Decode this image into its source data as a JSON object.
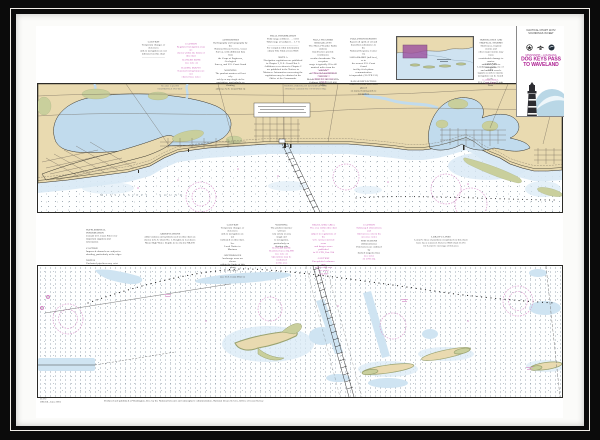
{
  "colors": {
    "frame": "#0b0b0b",
    "fillet": "#f1eee8",
    "matte": "#fbfbf9",
    "paper": "#ffffff",
    "panel_border": "#2b2a26",
    "land": "#e9dab0",
    "marsh": "#c9cf9c",
    "bay": "#c1dbed",
    "shallow": "#d8e9f5",
    "shoreline": "#35332c",
    "road": "#6a6156",
    "channel": "#3a3a3a",
    "magenta": "#c44fae",
    "magenta_light": "#dc9ed0",
    "title_magenta": "#ad1f92",
    "note_black": "#3f3f3f",
    "note_gray": "#7a7a7a",
    "swoosh": "#b9d7e6",
    "lighthouse": "#2c2c31",
    "coverage": "#9b4f9f",
    "inset_water": "#cfe3f1"
  },
  "title_block": {
    "top_line_1": "NAUTICAL CHART 11372",
    "top_line_2": "SOUNDINGS IN FEET",
    "region": "MISSISSIPPI – LOUISIANA",
    "title_line_1": "DOG KEYS PASS",
    "title_line_2": "TO WAVELAND",
    "sub_line_1": "SCALE 1:40,000",
    "sub_line_2": "MERCATOR PROJECTION"
  },
  "chart": {
    "sound_label": "MISSISSIPPI SOUND"
  },
  "micro_notes": [
    {
      "name": "note-caution-aids",
      "x": 102,
      "y": 15,
      "w": 31,
      "color": "#3f3f3f",
      "align": "center",
      "lines": [
        "CAUTION",
        "Temporary changes or defects in",
        "aids to navigation are not",
        "indicated on this chart",
        "—————————"
      ]
    },
    {
      "name": "note-regulated-areas",
      "x": 139,
      "y": 17,
      "w": 32,
      "color": "#c44fae",
      "align": "center",
      "lines": [
        "CAUTION",
        "Regulated navigation areas are",
        "shown within the limits of",
        "this chart"
      ]
    },
    {
      "name": "note-danger-zone",
      "x": 144,
      "y": 33,
      "w": 23,
      "color": "#c44fae",
      "align": "center",
      "lines": [
        "DANGER ZONE",
        "(see note A)"
      ]
    },
    {
      "name": "note-racing-buoys",
      "x": 140,
      "y": 41,
      "w": 30,
      "color": "#c44fae",
      "align": "center",
      "lines": [
        "RACING BUOYS",
        "Seasonal racing buoys are not",
        "charted (see note)"
      ]
    },
    {
      "name": "note-authorities",
      "x": 177,
      "y": 13,
      "w": 35,
      "color": "#3f3f3f",
      "align": "center",
      "lines": [
        "AUTHORITIES",
        "Hydrography and topography by the",
        "National Ocean Service, Coast",
        "Survey, with additional data from",
        "the Corps of Engineers, Geological",
        "Survey, and U.S. Coast Guard",
        "",
        "WARNING",
        "The prudent mariner will not rely",
        "solely on any single aid to",
        "navigation, particularly on floating",
        "aids (see U.S. Coast Pilot 5)"
      ]
    },
    {
      "name": "note-tidal-information",
      "x": 224,
      "y": 9,
      "w": 46,
      "color": "#3f3f3f",
      "align": "center",
      "lines": [
        "TIDAL INFORMATION",
        "Tidal range at Biloxi . . . 1.8 ft",
        "Tidal range at Gulfport . . 1.7 ft",
        "————————————",
        "For complete tidal information",
        "obtain Tide Tables from NOS",
        "",
        "NOTE A",
        "Navigation regulations are published",
        "in Chapter 2, U.S. Coast Pilot 5.",
        "Additions or revisions to Chapter 2",
        "are published in the Notices to",
        "Mariners. Information concerning the",
        "regulations may be obtained at the",
        "Office of the Commander"
      ]
    },
    {
      "name": "note-weather-broadcasts",
      "x": 271,
      "y": 13,
      "w": 32,
      "color": "#3f3f3f",
      "align": "center",
      "lines": [
        "NOAA WEATHER BROADCASTS",
        "The NOAA Weather Radio stations",
        "listed below provide continuous",
        "weather broadcasts. The reception",
        "range is typically 20 to 40",
        "nautical miles from the antenna",
        "site. New Orleans KHB-43 162.550",
        "Mobile KEC-61 162.550 MHz",
        "Gulfport WXJ-99 162.400 MHz"
      ]
    },
    {
      "name": "note-pilings-caution",
      "x": 274,
      "y": 43,
      "w": 27,
      "color": "#c44fae",
      "align": "center",
      "lines": [
        "CAUTION",
        "Submerged pilings and obstructions",
        "exist in this area (see note)"
      ]
    },
    {
      "name": "note-pollution-reports",
      "x": 313,
      "y": 12,
      "w": 29,
      "color": "#3f3f3f",
      "align": "center",
      "lines": [
        "POLLUTION REPORTS",
        "Report all spills of oil and",
        "hazardous substances to the",
        "National Response Center via",
        "1-800-424-8802 (toll free), or to",
        "the nearest U.S. Coast Guard",
        "facility if telephone communication",
        "is impossible (33 CFR 153)",
        "",
        "RADAR REFLECTORS",
        "Radar reflectors have been placed",
        "on many floating aids to navigation"
      ]
    },
    {
      "name": "note-hurricanes",
      "x": 441,
      "y": 13,
      "w": 28,
      "color": "#3f3f3f",
      "align": "center",
      "lines": [
        "HURRICANES AND",
        "TROPICAL STORMS",
        "Hurricanes, tropical storms and",
        "other major storms may cause",
        "considerable damage to marine",
        "structures, aids to navigation",
        "and moored vessels"
      ]
    },
    {
      "name": "note-radio-caution",
      "x": 441,
      "y": 37,
      "w": 27,
      "color": "#3f3f3f",
      "align": "center",
      "lines": [
        "CAUTION",
        "Limitations on the use of radio",
        "signals as aids to marine",
        "navigation can be found in the",
        "U.S. Coast Guard Light Lists"
      ]
    },
    {
      "name": "note-cable-area",
      "x": 443,
      "y": 53,
      "w": 23,
      "color": "#c44fae",
      "align": "center",
      "lines": [
        "CABLE AREA",
        "(see note)"
      ]
    },
    {
      "name": "panel-scale-note",
      "x": 104,
      "y": 59,
      "w": 60,
      "color": "#7a7a7a",
      "align": "center",
      "lines": [
        "SCALE 1:40,000",
        "SOUNDINGS IN FEET"
      ]
    },
    {
      "name": "panel-datum-note",
      "x": 232,
      "y": 59,
      "w": 75,
      "color": "#7a7a7a",
      "align": "center",
      "lines": [
        "NORTH AMERICAN DATUM OF 1983",
        "(WORLD GEODETIC SYSTEM 1984)"
      ]
    },
    {
      "name": "note-supplemental",
      "x": 50,
      "y": 203,
      "w": 36,
      "color": "#3f3f3f",
      "align": "left",
      "lines": [
        "SUPPLEMENTAL INFORMATION",
        "Consult U.S. Coast Pilot 5 for",
        "important supplemental information",
        "",
        "CAUTION",
        "Improved channels are subject to",
        "shoaling, particularly at the edges",
        "",
        "NOTE B",
        "Uncharted pipelines may exist"
      ]
    },
    {
      "name": "note-abbreviations",
      "x": 107,
      "y": 207,
      "w": 54,
      "color": "#3f3f3f",
      "align": "center",
      "lines": [
        "ABBREVIATIONS",
        "Abbreviations and symbols used on this chart are",
        "shown in U.S. Chart No. 1. Heights in feet above",
        "Mean High Water. Depths in feet below MLLW"
      ]
    },
    {
      "name": "note-anchorages",
      "x": 184,
      "y": 198,
      "w": 25,
      "color": "#3f3f3f",
      "align": "center",
      "lines": [
        "CAUTION",
        "Temporary changes or defects in",
        "aids to navigation are not",
        "indicated on this chart. See",
        "Local Notice to Mariners",
        "",
        "ANCHORAGES",
        "Anchorage areas are shown",
        "within the limits of this chart",
        "(see note)",
        "",
        "(see U.S. Coast Pilot 5)"
      ]
    },
    {
      "name": "note-warning-middle",
      "x": 233,
      "y": 198,
      "w": 25,
      "color": "#3f3f3f",
      "align": "center",
      "lines": [
        "WARNING",
        "The prudent mariner will not",
        "rely solely on any single aid",
        "to navigation, particularly on",
        "floating aids"
      ]
    },
    {
      "name": "note-danger-restricted",
      "x": 233,
      "y": 221,
      "w": 25,
      "color": "#c44fae",
      "align": "center",
      "lines": [
        "DANGER ZONE",
        "Restricted area 334.980",
        "(see note A)",
        "Operations may be conducted",
        "in this area"
      ]
    },
    {
      "name": "note-regulated-area",
      "x": 274,
      "y": 198,
      "w": 27,
      "color": "#c44fae",
      "align": "center",
      "lines": [
        "REGULATED AREA",
        "The area within this chart is",
        "subject to regulations of the",
        "U.S. Army restricted areas",
        "and danger zones published",
        "in 33 CFR, Part 334",
        "",
        "CAUTION",
        "Unexploded ordnance may",
        "exist in this area",
        "(see note)",
        "334.980"
      ]
    },
    {
      "name": "note-fish-havens-1",
      "x": 319,
      "y": 198,
      "w": 28,
      "color": "#c44fae",
      "align": "center",
      "lines": [
        "CAUTION",
        "Submerged obstructions and",
        "fish havens exist in the",
        "area (see note)"
      ]
    },
    {
      "name": "note-fish-havens-2",
      "x": 319,
      "y": 214,
      "w": 28,
      "color": "#3f3f3f",
      "align": "center",
      "lines": [
        "FISH HAVENS",
        "(Obstructions)",
        "Fish havens are outlined by",
        "dashed magenta lines"
      ]
    },
    {
      "name": "note-fish-havens-3",
      "x": 319,
      "y": 229,
      "w": 28,
      "color": "#c44fae",
      "align": "center",
      "lines": [
        "(see note)",
        "33 CFR 334"
      ]
    },
    {
      "name": "note-loran",
      "x": 376,
      "y": 210,
      "w": 58,
      "color": "#3f3f3f",
      "align": "center",
      "lines": [
        "LORAN-C LINES",
        "Loran-C lines of position overprinted on this chart",
        "have been removed. Refer to NOS chart 11373",
        "for Loran-C coverage of this area"
      ]
    },
    {
      "name": "footer-edition",
      "x": 4,
      "y": 372,
      "w": 34,
      "color": "#3f3f3f",
      "align": "left",
      "lines": [
        "11372",
        "59th Ed., June 2016"
      ]
    },
    {
      "name": "footer-credit",
      "x": 68,
      "y": 374,
      "w": 190,
      "color": "#3f3f3f",
      "align": "left",
      "lines": [
        "Produced and published at Washington, D.C. by the National Oceanic and Atmospheric Administration, National Ocean Service, Office of Coast Survey"
      ]
    }
  ]
}
